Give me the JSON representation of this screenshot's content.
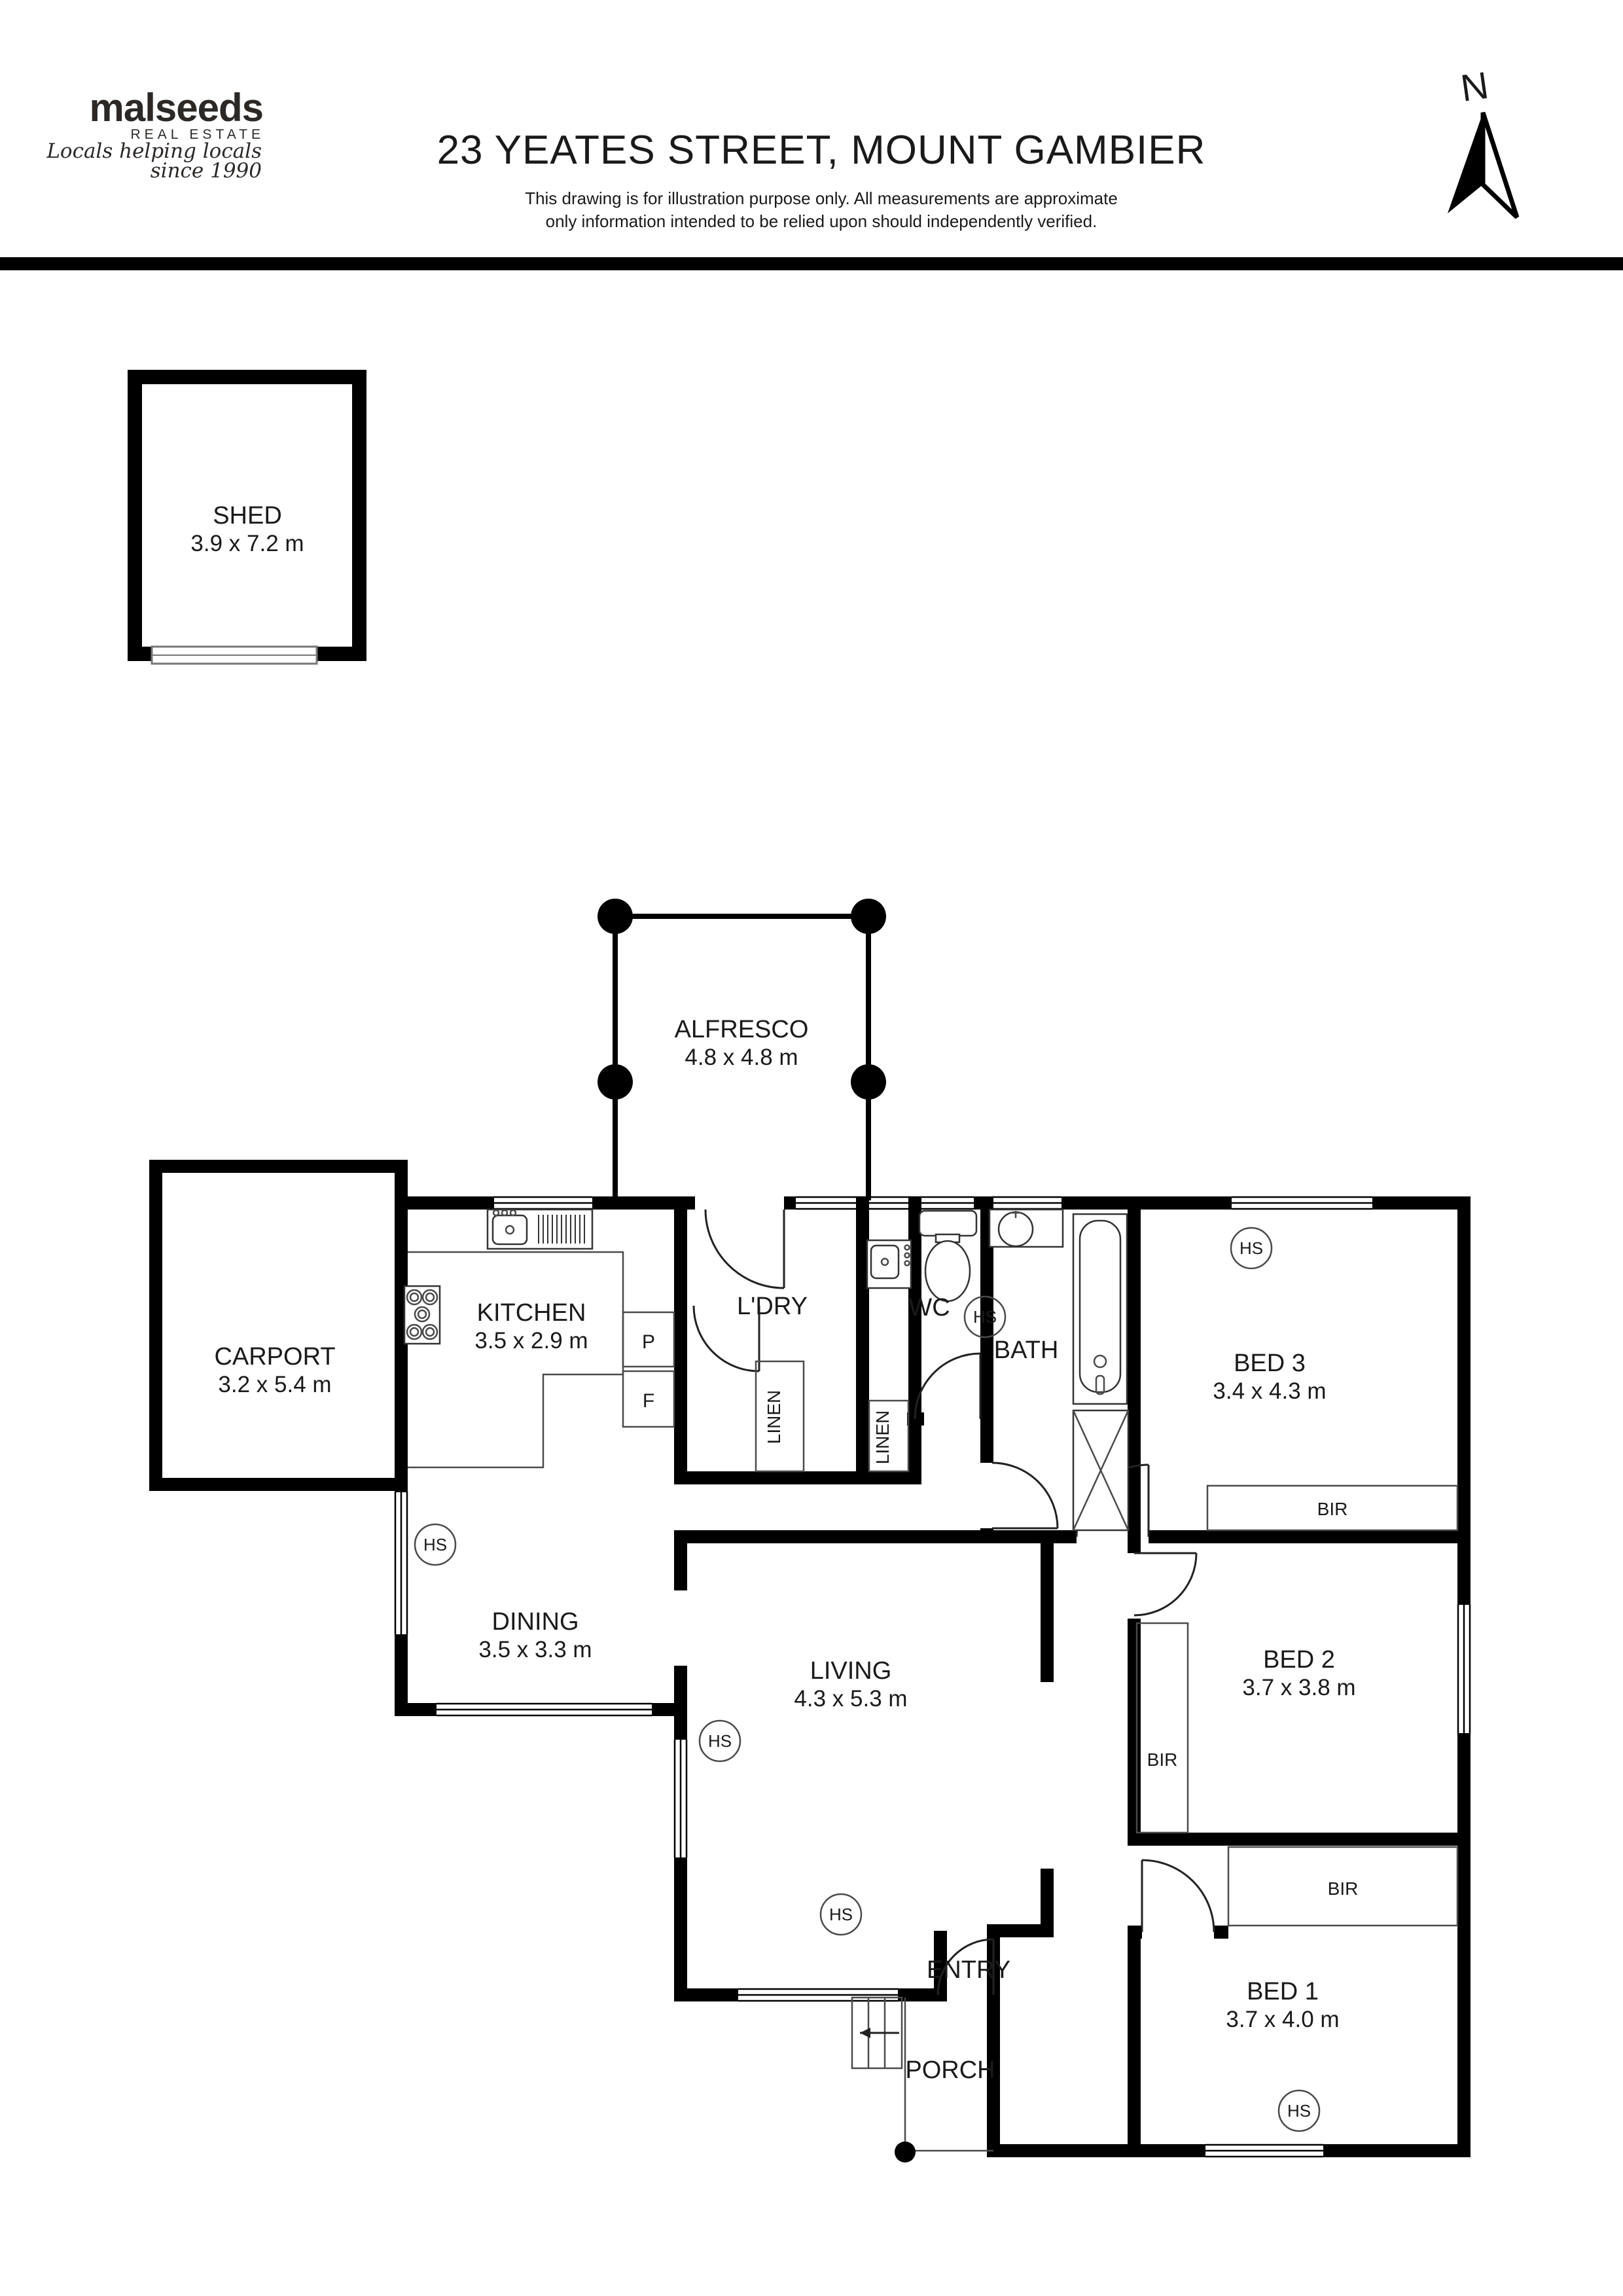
{
  "header": {
    "logo_name": "malseeds",
    "logo_sub": "REAL ESTATE",
    "logo_script_line1": "Locals helping locals",
    "logo_script_line2": "since 1990",
    "title": "23 YEATES STREET, MOUNT GAMBIER",
    "disclaimer_line1": "This drawing is for illustration purpose only. All measurements are approximate",
    "disclaimer_line2": "only information intended to be relied upon should independently verified.",
    "north_label": "N"
  },
  "rooms": {
    "shed": {
      "name": "SHED",
      "dims": "3.9 x 7.2 m"
    },
    "alfresco": {
      "name": "ALFRESCO",
      "dims": "4.8 x 4.8 m"
    },
    "carport": {
      "name": "CARPORT",
      "dims": "3.2 x 5.4 m"
    },
    "kitchen": {
      "name": "KITCHEN",
      "dims": "3.5 x 2.9 m"
    },
    "laundry": {
      "name": "L'DRY"
    },
    "wc": {
      "name": "WC"
    },
    "bath": {
      "name": "BATH"
    },
    "dining": {
      "name": "DINING",
      "dims": "3.5 x 3.3 m"
    },
    "living": {
      "name": "LIVING",
      "dims": "4.3 x 5.3 m"
    },
    "bed3": {
      "name": "BED 3",
      "dims": "3.4 x 4.3 m"
    },
    "bed2": {
      "name": "BED 2",
      "dims": "3.7 x 3.8 m"
    },
    "bed1": {
      "name": "BED 1",
      "dims": "3.7 x 4.0 m"
    },
    "entry": {
      "name": "ENTRY"
    },
    "porch": {
      "name": "PORCH"
    }
  },
  "storage": {
    "linen": "LINEN",
    "bir": "BIR",
    "pantry": "P",
    "fridge": "F"
  },
  "markers": {
    "hs": "HS"
  },
  "colors": {
    "wall": "#000000",
    "text": "#1a1a1a",
    "background": "#ffffff"
  }
}
